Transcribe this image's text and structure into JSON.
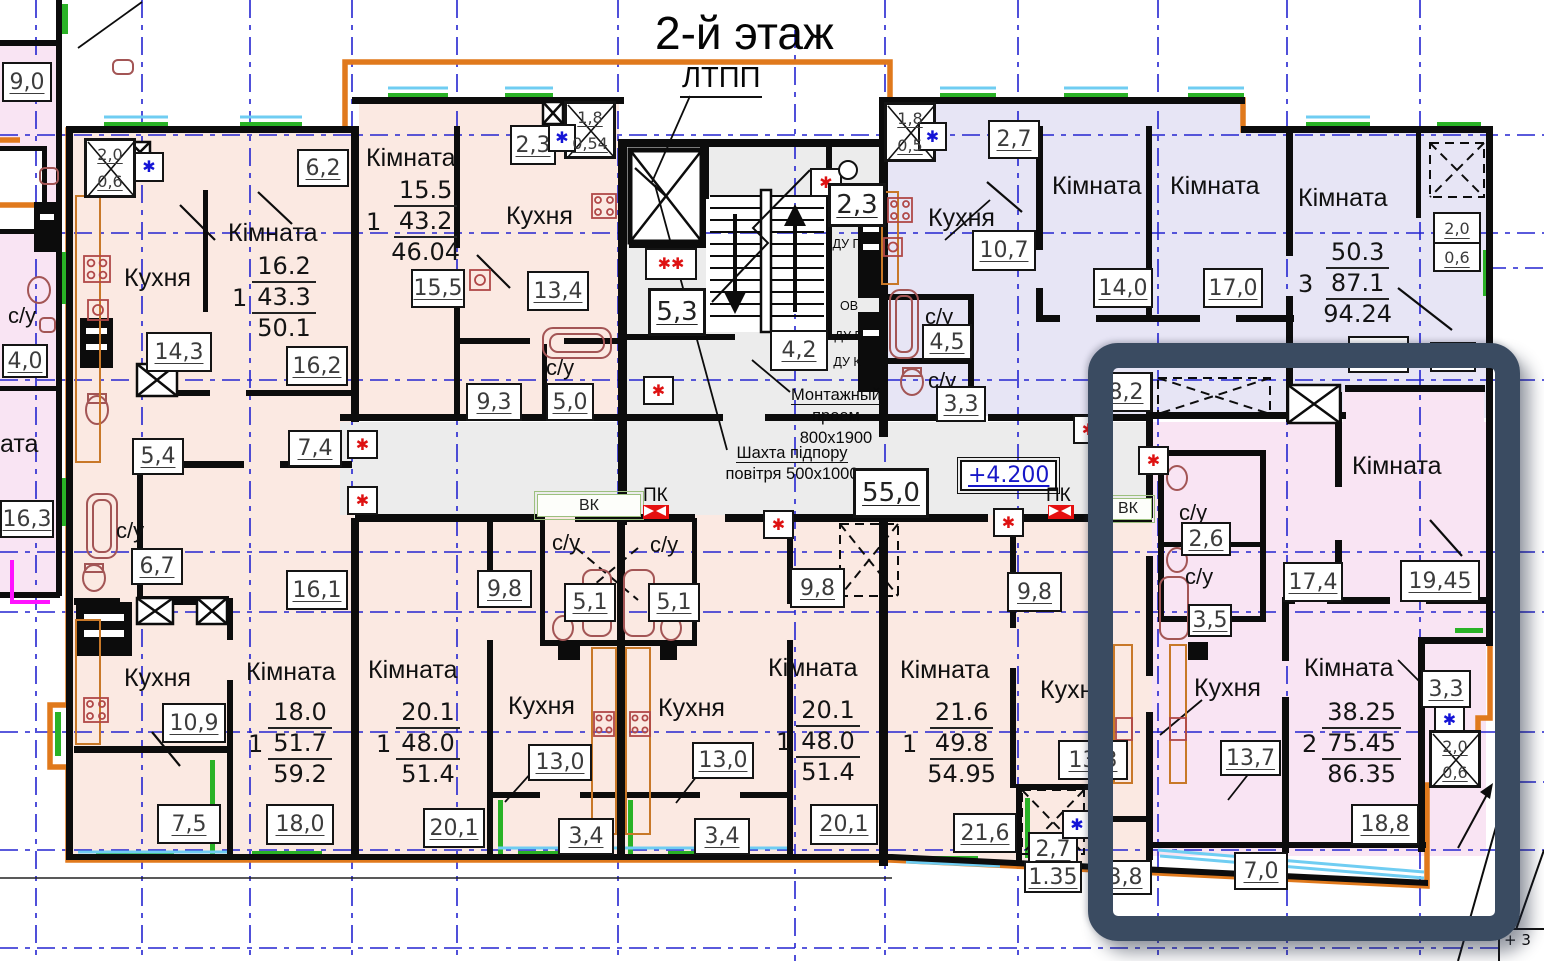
{
  "title": "2-й этаж",
  "colors": {
    "outline": "#e0791c",
    "grid": "#2424d0",
    "highlight": "#3a4b61",
    "peach": "#fbe9e2",
    "lavender": "#e7e5f5",
    "pink": "#f9e4f3",
    "corridor": "#ececec",
    "window_green": "#2ab226",
    "window_blue": "#6fcdf2",
    "fixture": "#a35555",
    "red": "#de1212",
    "blue": "#1414d6",
    "magenta": "#ff12ff"
  },
  "symbols": {
    "red_asterisk": "✱",
    "double_asterisk": "✱✱",
    "blue_asterisk": "✱"
  },
  "core": {
    "ltpp": "ЛТПП",
    "stair_area": "5,3",
    "lobby_area": "4,2",
    "vestibule_area": "2,3",
    "du_p1": "ДУ П",
    "ov": "ОВ",
    "du_p2": "ДУ П",
    "du_k": "ДУ К",
    "corridor_area": "55,0",
    "elevation": "+4.200",
    "mount_line1": "Монтажный",
    "mount_line2": "проем",
    "mount_line3": "800х1900",
    "shaft_line1": "Шахта підпору",
    "shaft_line2": "повітря 500х1000",
    "vk": "ВК",
    "pk": "ПК",
    "corner_note": "+ 3"
  },
  "left_strip": {
    "area_top": "9,0",
    "wc": "с/у",
    "wc_area": "4,0",
    "room_suffix": "ата",
    "room_area": "16,3",
    "vent_top": "2,0",
    "vent_bot": "0,6"
  },
  "apt_top_left": {
    "room": "Кімната",
    "live": "16.2",
    "n": "1",
    "total": "43.3",
    "full": "50.1",
    "kitchen": "Кухня",
    "kitchen_area": "14,3",
    "room_area": "16,2",
    "balcony_area": "6,2",
    "hall_area": "7,4",
    "pantry_area": "5,4",
    "wc": "с/у",
    "wc_area": "6,7",
    "hall2_area": "16,1"
  },
  "apt_top_mid": {
    "room": "Кімната",
    "live": "15.5",
    "n": "1",
    "total": "43.2",
    "full": "46.04",
    "room_area": "15,5",
    "kitchen": "Кухня",
    "kitchen_area": "13,4",
    "balcony_area": "2,3",
    "vent_top": "1,8",
    "vent_bot": "0,54",
    "wc": "с/у",
    "wc_area": "5,0",
    "hall_area": "9,3"
  },
  "apt_top_right": {
    "kitchen": "Кухня",
    "kitchen_area": "10,7",
    "balcony_area": "2,7",
    "vent_top": "1,8",
    "vent_bot": "0,5",
    "wc1": "с/у",
    "wc1_area": "4,5",
    "wc2": "с/у",
    "wc2_area": "3,3",
    "room1": "Кімната",
    "room1_area": "14,0",
    "room2": "Кімната",
    "room2_area": "17,0",
    "room3": "Кімната",
    "n": "3",
    "live": "50.3",
    "total": "87.1",
    "full": "94.24",
    "hall_area": "8,2",
    "vent2_top": "2,0",
    "vent2_bot": "0,6"
  },
  "apt_bot_1": {
    "kitchen": "Кухня",
    "kitchen_area": "10,9",
    "balcony_area": "7,5",
    "room": "Кімната",
    "live": "18.0",
    "n": "1",
    "total": "51.7",
    "full": "59.2",
    "room_area": "18,0"
  },
  "apt_bot_2": {
    "room": "Кімната",
    "live": "20.1",
    "n": "1",
    "total": "48.0",
    "full": "51.4",
    "room_area": "20,1",
    "hall_area": "9,8",
    "wc": "с/у",
    "wc_area": "5,1",
    "kitchen": "Кухня",
    "kitchen_area": "13,0",
    "balcony_area": "3,4"
  },
  "apt_bot_3": {
    "wc": "с/у",
    "wc_area": "5,1",
    "kitchen": "Кухня",
    "kitchen_area": "13,0",
    "balcony_area": "3,4",
    "hall_area": "9,8",
    "room": "Кімната",
    "live": "20.1",
    "n": "1",
    "total": "48.0",
    "full": "51.4",
    "room_area": "20,1"
  },
  "apt_bot_4": {
    "room": "Кімната",
    "live": "21.6",
    "n": "1",
    "total": "49.8",
    "full": "54.95",
    "room_area": "21,6",
    "hall_area": "9,8",
    "kitchen": "Кухня",
    "kitchen_area": "13,3",
    "balcony_area": "2,7",
    "balcony_reduced": "1.35",
    "store_area": "3,8"
  },
  "apt_highlight": {
    "vk": "ВК",
    "room1": "Кімната",
    "room1_area": "19,45",
    "hall_area": "17,4",
    "wc1": "с/у",
    "wc1_area": "2,6",
    "wc2": "с/у",
    "wc2_area": "3,5",
    "kitchen": "Кухня",
    "kitchen_area": "13,7",
    "room2": "Кімната",
    "live": "38.25",
    "n": "2",
    "total": "75.45",
    "full": "86.35",
    "room2_area": "18,8",
    "balcony_area": "3,3",
    "vent_top": "2,0",
    "vent_bot": "0,6",
    "loggia_area": "7,0"
  }
}
